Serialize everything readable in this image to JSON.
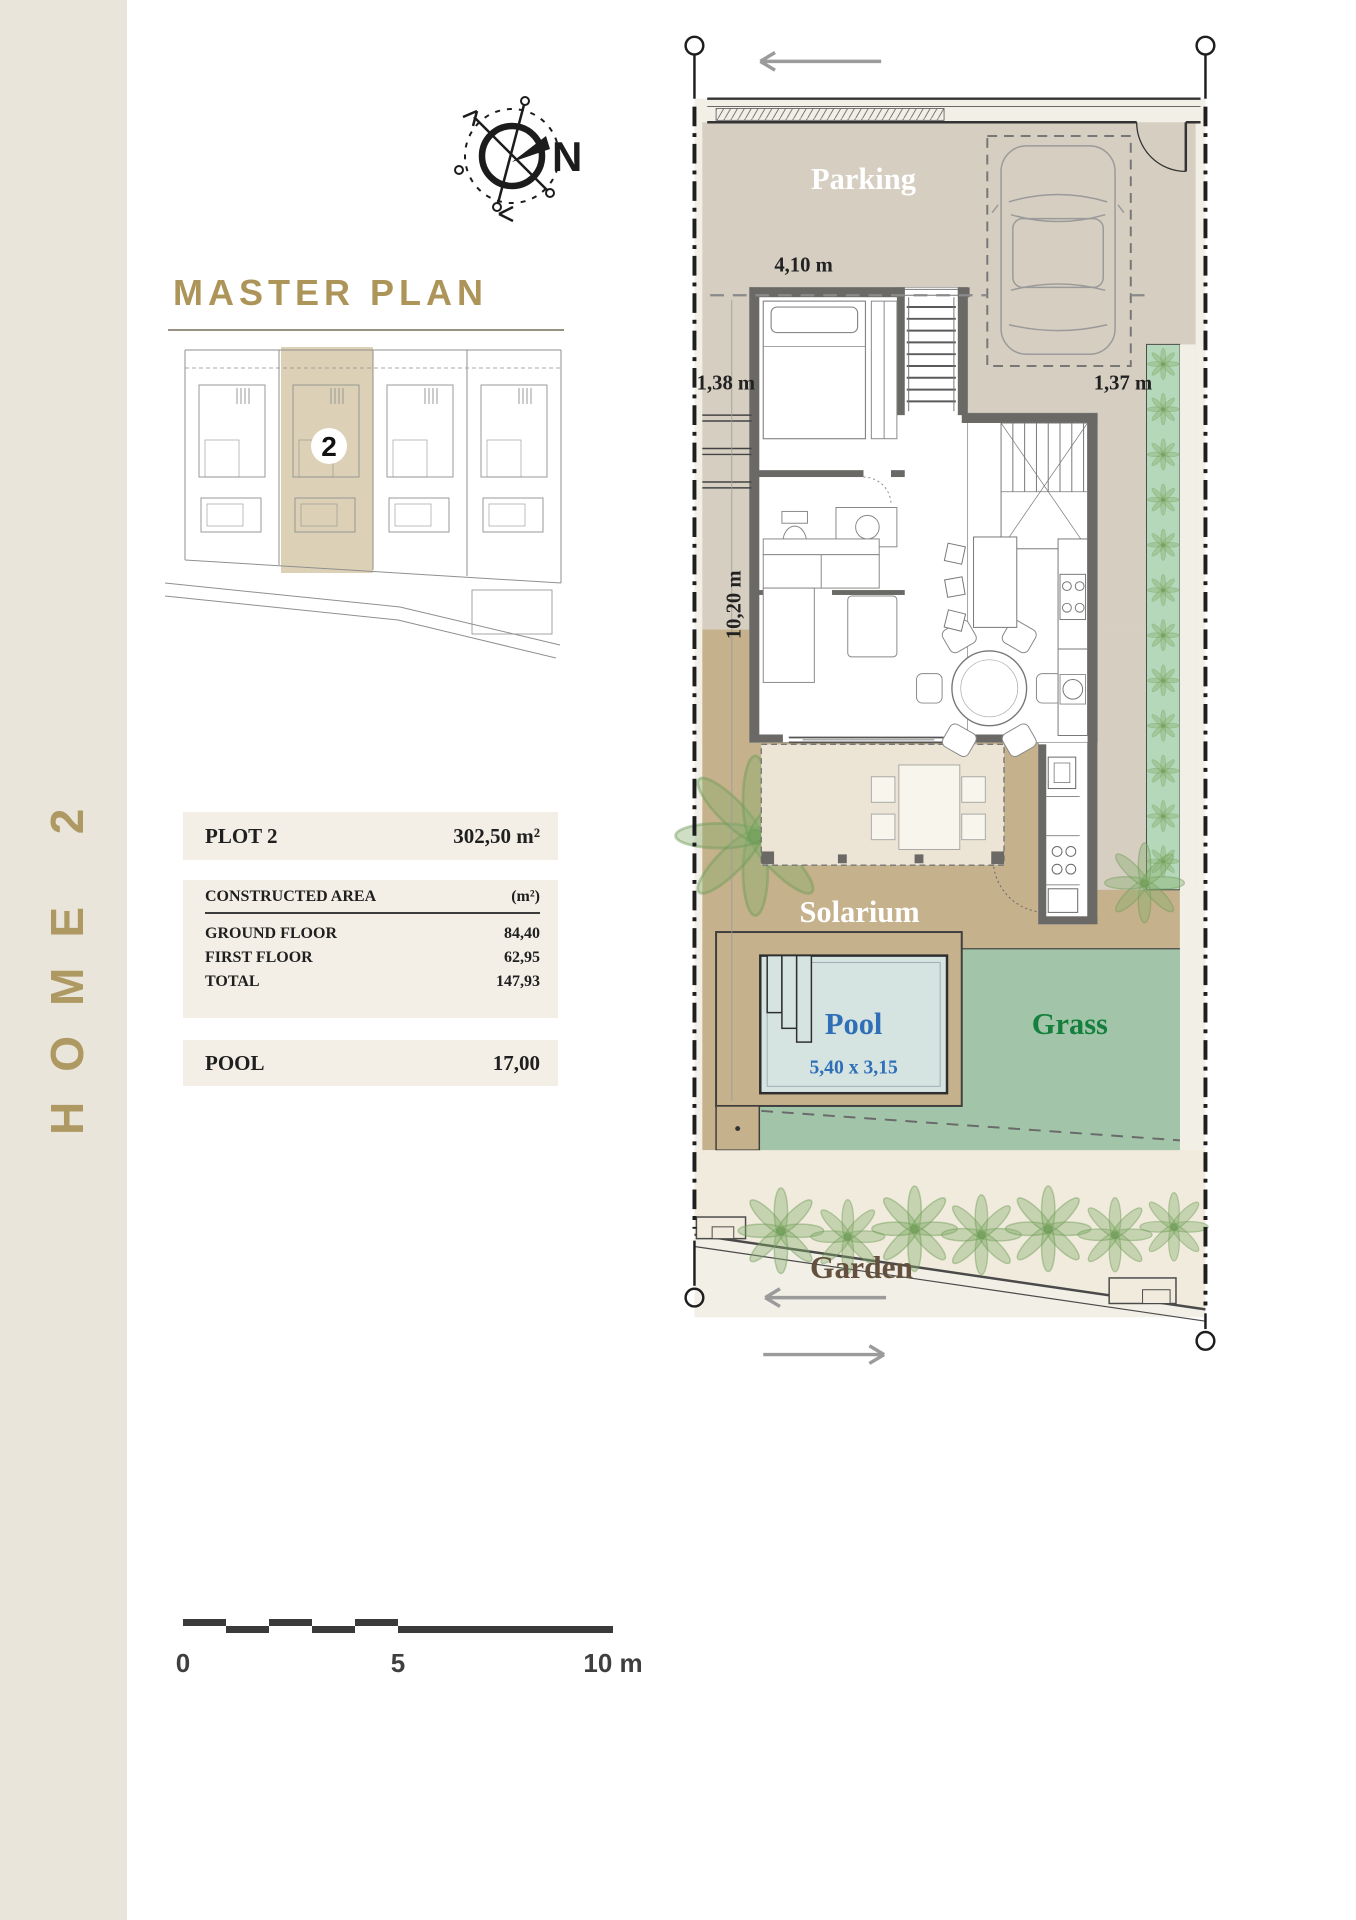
{
  "sidebar": {
    "vertical_title": "HOME 2"
  },
  "compass": {
    "north": "N"
  },
  "master_plan": {
    "title": "MASTER PLAN",
    "plot_badge": "2"
  },
  "info_panel": {
    "plot_row": {
      "label": "PLOT 2",
      "value": "302,50 m²"
    },
    "constructed": {
      "header": "CONSTRUCTED AREA",
      "unit_header": "(m²)",
      "rows": [
        {
          "label": "GROUND FLOOR",
          "value": "84,40"
        },
        {
          "label": "FIRST FLOOR",
          "value": "62,95"
        },
        {
          "label": "TOTAL",
          "value": "147,93"
        }
      ]
    },
    "pool_row": {
      "label": "POOL",
      "value": "17,00"
    }
  },
  "floor_plan": {
    "labels": {
      "parking": "Parking",
      "solarium": "Solarium",
      "pool": "Pool",
      "pool_dimensions": "5,40 x 3,15",
      "grass": "Grass",
      "garden": "Garden"
    },
    "dimensions": {
      "top_width": "4,10 m",
      "left_setback": "1,38 m",
      "right_setback": "1,37 m",
      "side_length": "10,20 m"
    }
  },
  "scale_bar": {
    "zero": "0",
    "five": "5",
    "ten": "10 m"
  },
  "colors": {
    "gold": "#AD9459",
    "sidebar_beige": "#EAE5DB",
    "parking_taupe": "#D5CEC1",
    "solarium_tan": "#C5B18B",
    "pool_water": "#D6E4E1",
    "pool_text": "#2E6FB7",
    "grass_green": "#A2C5A9",
    "grass_text": "#15803D",
    "garden_cream": "#F0EBDC",
    "garden_text": "#64513D",
    "band_beige": "#F3EFE7",
    "wall_gray": "#6B6965"
  }
}
